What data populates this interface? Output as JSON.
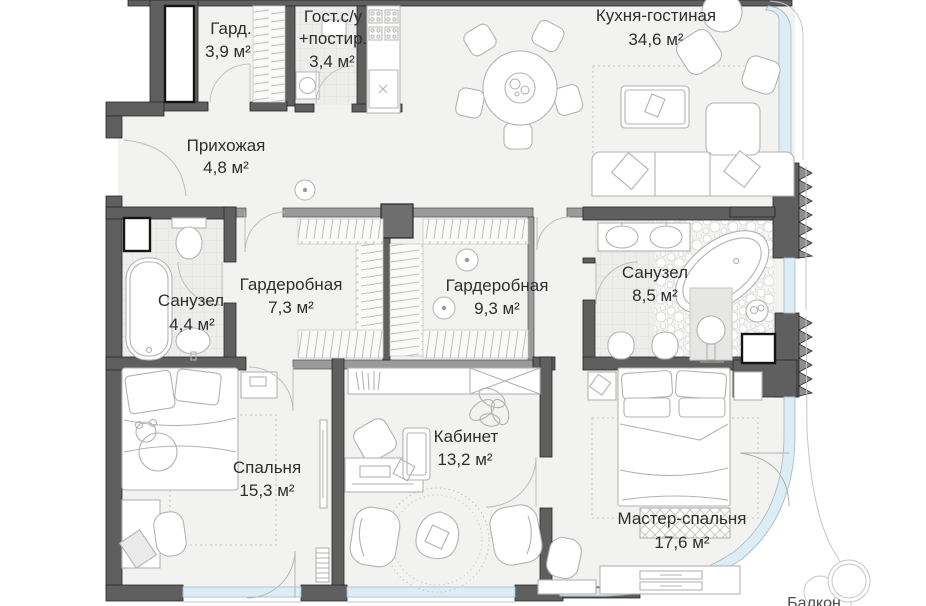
{
  "plan": {
    "title": "Apartment floor plan",
    "rooms": {
      "gard": {
        "name": "Гард.",
        "area": "3,9 м²"
      },
      "guest_wc": {
        "name_line1": "Гост.с/у",
        "name_line2": "+постир.",
        "area": "3,4 м²"
      },
      "kitchen_living": {
        "name": "Кухня-гостиная",
        "area": "34,6 м²"
      },
      "hallway": {
        "name": "Прихожая",
        "area": "4,8 м²"
      },
      "bathroom_small": {
        "name": "Санузел",
        "area": "4,4 м²"
      },
      "wardrobe_1": {
        "name": "Гардеробная",
        "area": "7,3 м²"
      },
      "wardrobe_2": {
        "name": "Гардеробная",
        "area": "9,3 м²"
      },
      "bathroom_master": {
        "name": "Санузел",
        "area": "8,5 м²"
      },
      "bedroom": {
        "name": "Спальня",
        "area": "15,3 м²"
      },
      "office": {
        "name": "Кабинет",
        "area": "13,2 м²"
      },
      "master_bedroom": {
        "name": "Мастер-спальня",
        "area": "17,6 м²"
      },
      "balcony": {
        "name": "Балкон"
      }
    },
    "colors": {
      "wall_dark": "#5f5f5f",
      "wall_light": "#9a9a9a",
      "glass": "#ddedf6",
      "floor": "#f2f2f0",
      "tile": "#ededeb",
      "text": "#2e2e2e"
    }
  }
}
